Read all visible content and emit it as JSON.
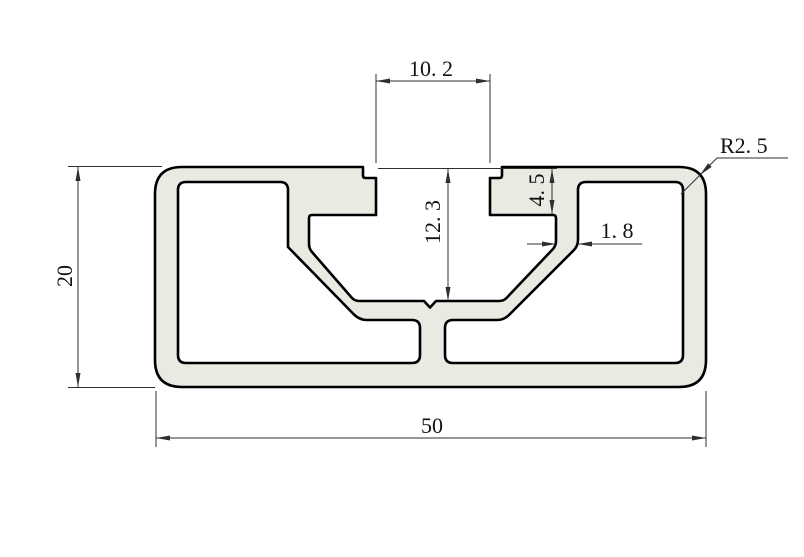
{
  "drawing": {
    "colors": {
      "background": "#ffffff",
      "profile_fill": "#e9eae2",
      "outline_color": "#000000",
      "dimension_color": "#2f2f2f",
      "text_color": "#121212"
    },
    "dimensions": {
      "slot_opening_width": {
        "label": "10. 2",
        "value": 10.2
      },
      "slot_depth": {
        "label": "12. 3",
        "value": 12.3
      },
      "lip_depth": {
        "label": "4. 5",
        "value": 4.5
      },
      "wall_thickness": {
        "label": "1. 8",
        "value": 1.8
      },
      "corner_radius": {
        "label": "R2. 5",
        "value": 2.5
      },
      "profile_height": {
        "label": "20",
        "value": 20
      },
      "profile_width": {
        "label": "50",
        "value": 50
      }
    }
  }
}
